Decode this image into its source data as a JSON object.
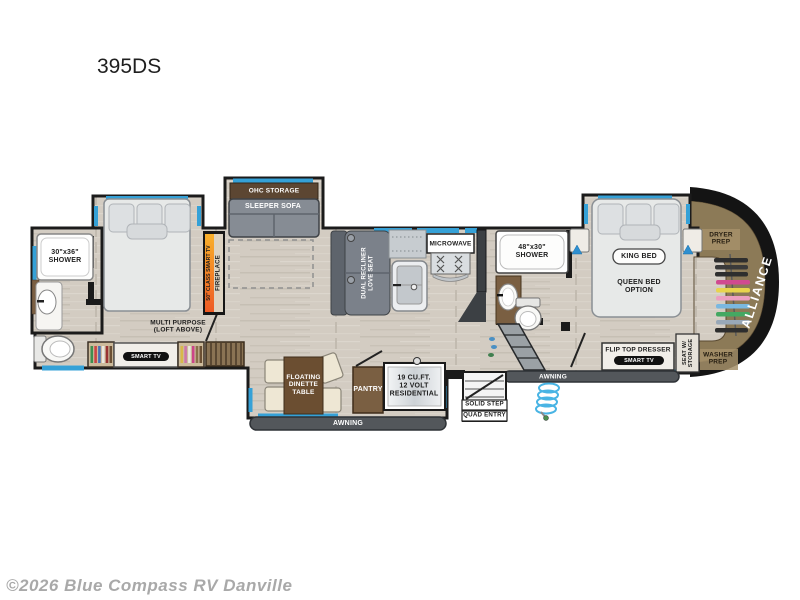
{
  "page": {
    "title": "395DS",
    "watermark": "©2026 Blue Compass RV Danville"
  },
  "colors": {
    "accent_blue": "#35a1d7",
    "wall_black": "#1b1b1b",
    "floor_tan": "#d3ccc2",
    "cabinet_brown": "#7a5f42",
    "overhead_brown": "#5c4632",
    "awning_gray": "#53575b",
    "cap_interior_brown": "#8c7a57",
    "fireplace_orange": "#f08423",
    "sofa_gray": "#868c94"
  },
  "floorplan": {
    "brand": "ALLIANCE",
    "rear_bath": {
      "shower": "30\"x36\"\nSHOWER"
    },
    "rear_bedroom": {
      "loft_note": "MULTI PURPOSE\n(LOFT ABOVE)",
      "tv": "SMART TV"
    },
    "living": {
      "overhead": "OHC STORAGE",
      "sofa": "SLEEPER SOFA",
      "fireplace_tv": "50\" CLASS SMART TV",
      "fireplace": "FIREPLACE",
      "loveseat": "DUAL RECLINER\nLOVE SEAT"
    },
    "kitchen": {
      "microwave": "MICROWAVE",
      "pantry": "PANTRY",
      "refrigerator": "19 CU.FT.\n12 VOLT\nRESIDENTIAL",
      "dinette": "FLOATING\nDINETTE\nTABLE"
    },
    "bathroom": {
      "shower": "48\"x30\"\nSHOWER"
    },
    "front_bedroom": {
      "bed": "KING BED",
      "bed_option": "QUEEN BED\nOPTION",
      "dresser": "FLIP TOP DRESSER",
      "tv": "SMART TV",
      "seat": "SEAT W/\nSTORAGE",
      "dryer_prep": "DRYER\nPREP",
      "washer_prep": "WASHER\nPREP"
    },
    "exterior": {
      "awning_main": "AWNING",
      "awning_entry": "AWNING",
      "entry_line1": "SOLID STEP",
      "entry_line2": "QUAD ENTRY"
    }
  }
}
